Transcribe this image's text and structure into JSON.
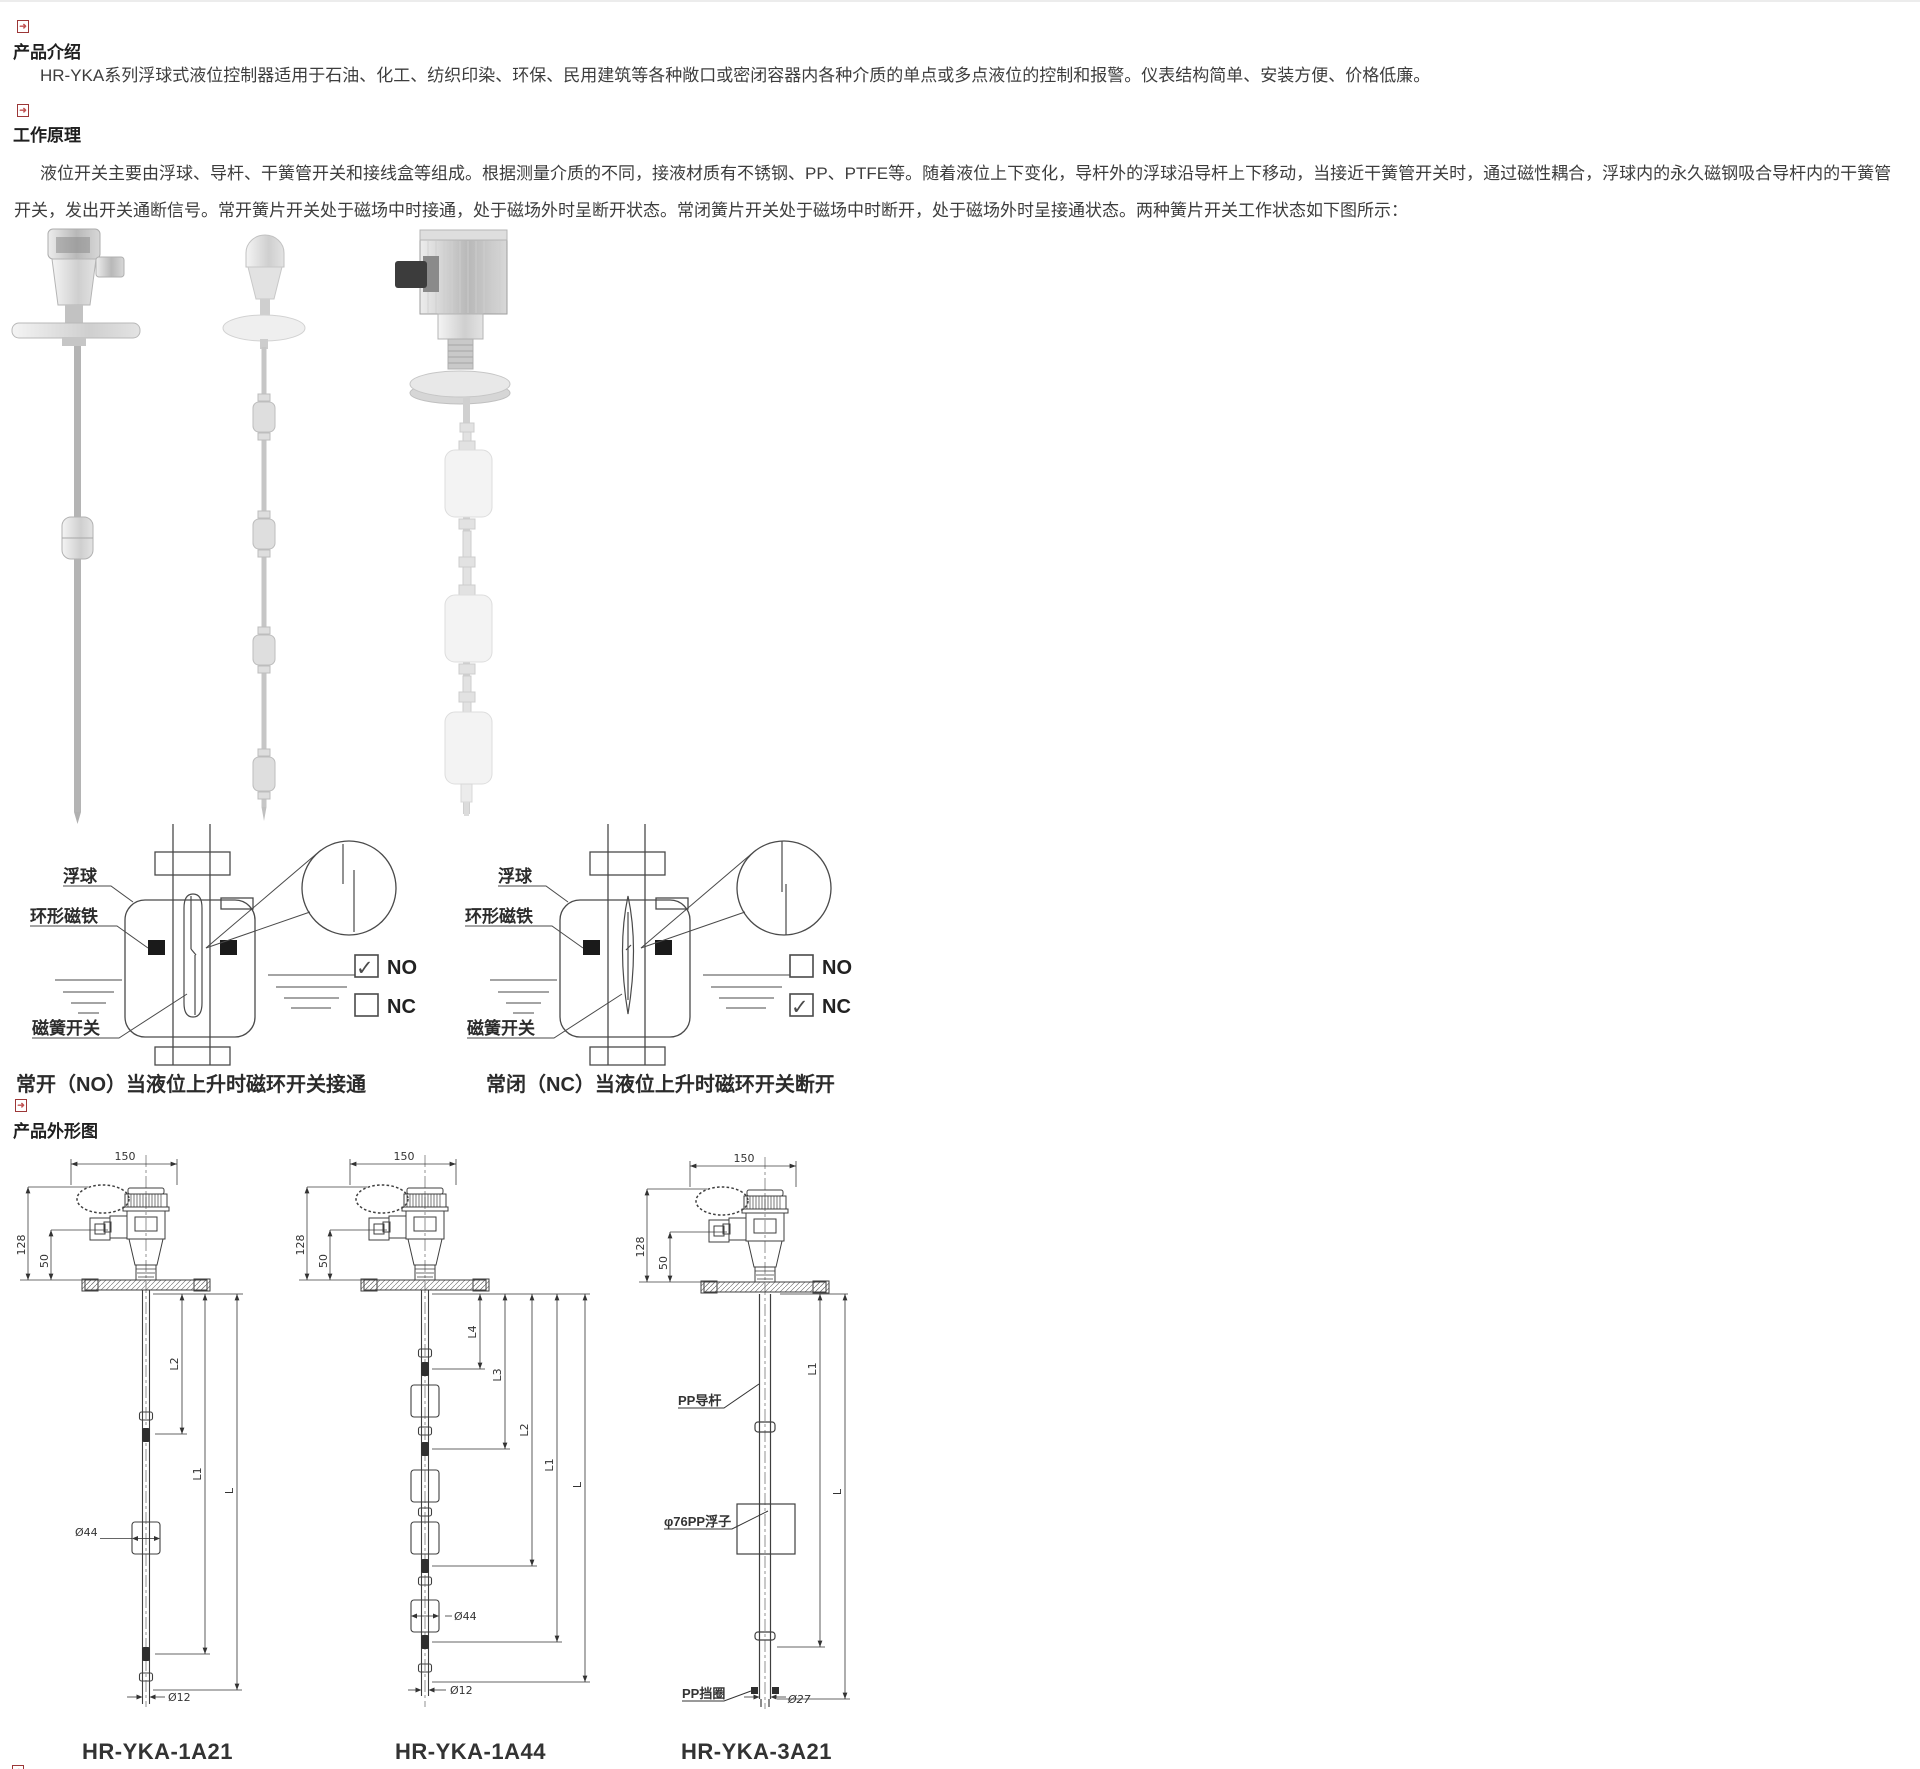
{
  "icons": {
    "bullet": "➜"
  },
  "intro": {
    "heading": "产品介绍",
    "body": "HR-YKA系列浮球式液位控制器适用于石油、化工、纺织印染、环保、民用建筑等各种敞口或密闭容器内各种介质的单点或多点液位的控制和报警。仪表结构简单、安装方便、价格低廉。"
  },
  "principle": {
    "heading": "工作原理",
    "body": "液位开关主要由浮球、导杆、干簧管开关和接线盒等组成。根据测量介质的不同，接液材质有不锈钢、PP、PTFE等。随着液位上下变化，导杆外的浮球沿导杆上下移动，当接近干簧管开关时，通过磁性耦合，浮球内的永久磁钢吸合导杆内的干簧管开关，发出开关通断信号。常开簧片开关处于磁场中时接通，处于磁场外时呈断开状态。常闭簧片开关处于磁场中时断开，处于磁场外时呈接通状态。两种簧片开关工作状态如下图所示："
  },
  "outline": {
    "heading": "产品外形图"
  },
  "diagram_no": {
    "float_label": "浮球",
    "magnet_label": "环形磁铁",
    "reed_label": "磁簧开关",
    "no_label": "NO",
    "nc_label": "NC",
    "no_check": "✓",
    "nc_check": "",
    "caption": "常开（NO）当液位上升时磁环开关接通"
  },
  "diagram_nc": {
    "float_label": "浮球",
    "magnet_label": "环形磁铁",
    "reed_label": "磁簧开关",
    "no_label": "NO",
    "nc_label": "NC",
    "no_check": "",
    "nc_check": "✓",
    "caption": "常闭（NC）当液位上升时磁环开关断开"
  },
  "drawing1": {
    "model": "HR-YKA-1A21",
    "dim_150": "150",
    "dim_128": "128",
    "dim_50": "50",
    "dim_l2": "L2",
    "dim_l1": "L1",
    "dim_l": "L",
    "dim_d44": "Ø44",
    "dim_d12": "Ø12"
  },
  "drawing2": {
    "model": "HR-YKA-1A44",
    "dim_150": "150",
    "dim_128": "128",
    "dim_50": "50",
    "dim_l4": "L4",
    "dim_l3": "L3",
    "dim_l2": "L2",
    "dim_l1": "L1",
    "dim_l": "L",
    "dim_d44": "Ø44",
    "dim_d12": "Ø12"
  },
  "drawing3": {
    "model": "HR-YKA-3A21",
    "dim_150": "150",
    "dim_128": "128",
    "dim_50": "50",
    "dim_l1": "L1",
    "dim_l": "L",
    "rod_label": "PP导杆",
    "float_label": "φ76PP浮子",
    "ring_label": "PP挡圈",
    "dim_d27": "Ø27"
  }
}
